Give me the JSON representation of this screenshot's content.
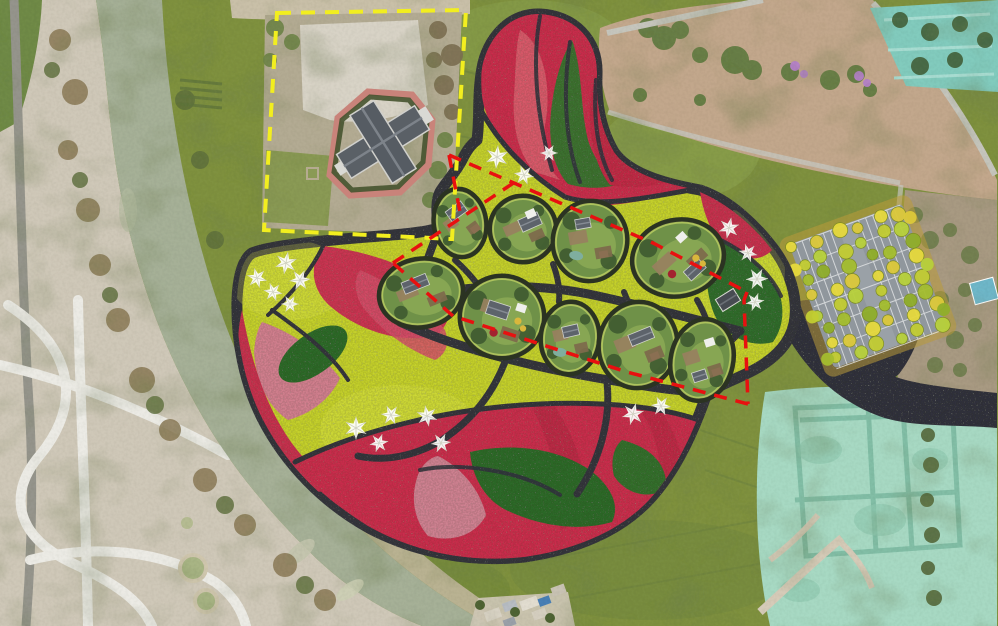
{
  "scene": {
    "type": "landscape-masterplan-over-aerial-photo",
    "canvas": {
      "width": 998,
      "height": 626
    }
  },
  "palette": {
    "field_olive": "#7f9140",
    "field_bright": "#8aa04b",
    "river": "#a6b097",
    "bank_tan": "#c0b69b",
    "pale_ground": "#cfc8b8",
    "path_white": "#ecebe5",
    "design_outline": "#34343e",
    "chartreuse": "#c6d22f",
    "crimson": "#ca2f4e",
    "red_deep": "#b62743",
    "lobe_red_light": "#d95f6e",
    "salmon_pink": "#d2808f",
    "dusty_pink": "#cf8292",
    "flower_green": "#2f6a2c",
    "dirt_field": "#c2a78c",
    "construction_mint": "#a7d9c3",
    "trench_teal": "#7cbaa2",
    "plaza_dark": "#33333c",
    "asphalt": "#90979d",
    "yellow_dash": "#f2ee1f",
    "red_dash": "#e81010",
    "pod_rim": "#2b3322",
    "pod_lawn": "#6f9148",
    "pod_lawn_light": "#8aa854",
    "building_gray": "#5d636b",
    "purple_tree": "#b481c8",
    "pool_blue": "#6fb7c9",
    "star_white": "#ffffff"
  },
  "regions": [
    {
      "name": "river",
      "fill": "#a6b097"
    },
    {
      "name": "riverside-road-and-park",
      "fill": "#cfc8b8"
    },
    {
      "name": "farm-fields",
      "fill": "#7f9140"
    },
    {
      "name": "estate-compound-in-yellow-parcel",
      "fill": "#bcb49d"
    },
    {
      "name": "flower-garden-masterplan",
      "fill": "#c6d22f"
    },
    {
      "name": "bare-dirt-field",
      "fill": "#c2a78c"
    },
    {
      "name": "construction-site",
      "fill": "#a7d9c3"
    },
    {
      "name": "tree-lined-parking-lot",
      "fill": "#90979d"
    },
    {
      "name": "residential-buildings",
      "fill": "#c9ced4"
    }
  ],
  "boundaries": {
    "yellow_parcel": {
      "name": "existing-estate-parcel-boundary",
      "color": "#f2ee1f",
      "dash": [
        14,
        10
      ],
      "width": 4,
      "points": [
        [
          277,
          13
        ],
        [
          466,
          10
        ],
        [
          452,
          239
        ],
        [
          264,
          230
        ]
      ]
    },
    "red_phase": {
      "name": "planning-phase-boundary",
      "color": "#e81010",
      "dash": [
        13,
        9
      ],
      "width": 3.5,
      "segments": [
        [
          [
            449,
            155
          ],
          [
            460,
            212
          ]
        ],
        [
          [
            449,
            155
          ],
          [
            653,
            243
          ],
          [
            747,
            292
          ]
        ],
        [
          [
            747,
            292
          ],
          [
            744,
            300
          ],
          [
            748,
            404
          ]
        ],
        [
          [
            748,
            404
          ],
          [
            627,
            372
          ],
          [
            453,
            316
          ]
        ],
        [
          [
            453,
            316
          ],
          [
            393,
            263
          ]
        ],
        [
          [
            393,
            263
          ],
          [
            518,
            180
          ]
        ]
      ]
    }
  },
  "stars": {
    "icon": "pinwheel-star-icon",
    "color": "#ffffff",
    "count": 19,
    "items": [
      {
        "x": 286,
        "y": 263,
        "s": 1.0,
        "r": 10
      },
      {
        "x": 257,
        "y": 278,
        "s": 0.9,
        "r": -15
      },
      {
        "x": 300,
        "y": 280,
        "s": 0.95,
        "r": 25
      },
      {
        "x": 273,
        "y": 292,
        "s": 0.85,
        "r": 40
      },
      {
        "x": 290,
        "y": 304,
        "s": 0.8,
        "r": -30
      },
      {
        "x": 497,
        "y": 157,
        "s": 1.05,
        "r": 5
      },
      {
        "x": 524,
        "y": 175,
        "s": 0.9,
        "r": -20
      },
      {
        "x": 549,
        "y": 153,
        "s": 0.8,
        "r": 30
      },
      {
        "x": 729,
        "y": 228,
        "s": 0.95,
        "r": 12
      },
      {
        "x": 748,
        "y": 253,
        "s": 0.85,
        "r": -18
      },
      {
        "x": 757,
        "y": 279,
        "s": 1.0,
        "r": 28
      },
      {
        "x": 755,
        "y": 302,
        "s": 0.85,
        "r": -40
      },
      {
        "x": 633,
        "y": 414,
        "s": 1.0,
        "r": 15
      },
      {
        "x": 661,
        "y": 406,
        "s": 0.9,
        "r": -25
      },
      {
        "x": 356,
        "y": 428,
        "s": 1.05,
        "r": 0
      },
      {
        "x": 391,
        "y": 415,
        "s": 0.9,
        "r": 35
      },
      {
        "x": 427,
        "y": 416,
        "s": 0.95,
        "r": -10
      },
      {
        "x": 379,
        "y": 443,
        "s": 0.85,
        "r": 20
      },
      {
        "x": 441,
        "y": 443,
        "s": 0.9,
        "r": -35
      }
    ]
  },
  "garden_pods": {
    "count": 9,
    "items": [
      {
        "cx": 460,
        "cy": 223,
        "rx": 26,
        "ry": 34,
        "rot": -8,
        "b": {
          "dx": -2,
          "dy": -12,
          "w": 19,
          "h": 12,
          "rot": -28
        },
        "extras": [
          "shed"
        ]
      },
      {
        "cx": 523,
        "cy": 229,
        "rx": 33,
        "ry": 33,
        "rot": 0,
        "b": {
          "dx": 7,
          "dy": -7,
          "w": 21,
          "h": 13,
          "rot": -24
        },
        "extras": [
          "canopy"
        ]
      },
      {
        "cx": 590,
        "cy": 241,
        "rx": 37,
        "ry": 40,
        "rot": 10,
        "b": {
          "dx": -10,
          "dy": -16,
          "w": 15,
          "h": 10,
          "rot": -20
        },
        "extras": [
          "shed",
          "pond"
        ]
      },
      {
        "cx": 678,
        "cy": 258,
        "rx": 46,
        "ry": 38,
        "rot": -12,
        "b": {
          "dx": 14,
          "dy": 15,
          "w": 20,
          "h": 12,
          "rot": -30
        },
        "extras": [
          "canopy",
          "red-bush",
          "umbrellas"
        ]
      },
      {
        "cx": 421,
        "cy": 293,
        "rx": 42,
        "ry": 34,
        "rot": -10,
        "b": {
          "dx": -4,
          "dy": -10,
          "w": 26,
          "h": 12,
          "rot": -12
        },
        "extras": []
      },
      {
        "cx": 502,
        "cy": 317,
        "rx": 42,
        "ry": 41,
        "rot": 0,
        "b": {
          "dx": -4,
          "dy": -7,
          "w": 22,
          "h": 14,
          "rot": 18
        },
        "extras": [
          "canopy",
          "red-bush",
          "umbrellas"
        ]
      },
      {
        "cx": 570,
        "cy": 338,
        "rx": 29,
        "ry": 36,
        "rot": 5,
        "b": {
          "dx": 0,
          "dy": -7,
          "w": 16,
          "h": 11,
          "rot": -18
        },
        "extras": [
          "pond"
        ]
      },
      {
        "cx": 638,
        "cy": 345,
        "rx": 39,
        "ry": 43,
        "rot": 8,
        "b": {
          "dx": 2,
          "dy": -9,
          "w": 24,
          "h": 12,
          "rot": -30
        },
        "extras": [
          "shed"
        ]
      },
      {
        "cx": 702,
        "cy": 360,
        "rx": 31,
        "ry": 41,
        "rot": 12,
        "b": {
          "dx": 1,
          "dy": 16,
          "w": 14,
          "h": 10,
          "rot": -30
        },
        "extras": [
          "shed",
          "canopy"
        ]
      }
    ]
  },
  "pavilion": {
    "x": 728,
    "y": 300,
    "w": 21,
    "h": 14,
    "rot": -32
  },
  "parking": {
    "cx": 868,
    "cy": 286,
    "rot": -20,
    "w": 120,
    "h": 132,
    "stall_rows": 7,
    "stall_step": 22,
    "tree_colors": [
      "#e6d93c",
      "#c2cc32",
      "#a4bd2e",
      "#dcc93a",
      "#b7d03b",
      "#8fae2a"
    ],
    "tree_grid": {
      "cols": 6,
      "rows": 8
    }
  },
  "purple_trees": [
    {
      "x": 795,
      "y": 66,
      "r": 5
    },
    {
      "x": 804,
      "y": 74,
      "r": 4
    },
    {
      "x": 859,
      "y": 76,
      "r": 5
    },
    {
      "x": 867,
      "y": 83,
      "r": 4
    }
  ]
}
